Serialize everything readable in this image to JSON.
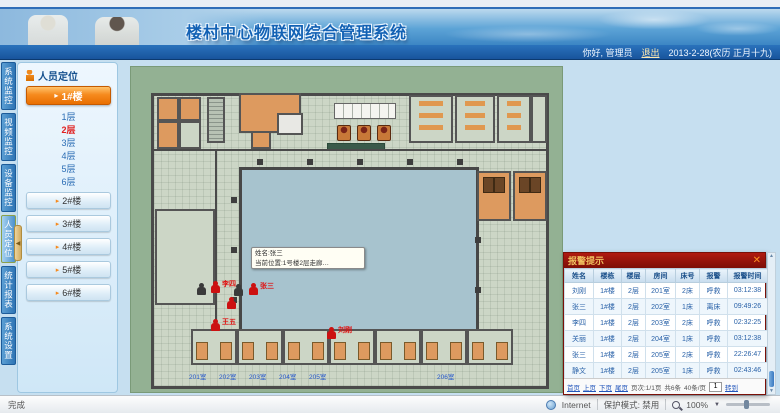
{
  "header": {
    "title": "楼村中心物联网综合管理系统",
    "greeting": "你好, 管理员",
    "logout": "退出",
    "date": "2013-2-28(农历 正月十九)"
  },
  "nav": {
    "tabs": [
      {
        "label": "系统监控",
        "active": false
      },
      {
        "label": "视频监控",
        "active": false
      },
      {
        "label": "设备监控",
        "active": false
      },
      {
        "label": "人员定位",
        "active": true
      },
      {
        "label": "统计报表",
        "active": false
      },
      {
        "label": "系统设置",
        "active": false
      }
    ]
  },
  "sidebar": {
    "panel_title": "人员定位",
    "active_building": "1#楼",
    "floors": [
      {
        "label": "1层",
        "active": false
      },
      {
        "label": "2层",
        "active": true
      },
      {
        "label": "3层",
        "active": false
      },
      {
        "label": "4层",
        "active": false
      },
      {
        "label": "5层",
        "active": false
      },
      {
        "label": "6层",
        "active": false
      }
    ],
    "buildings": [
      "2#楼",
      "3#楼",
      "4#楼",
      "5#楼",
      "6#楼"
    ]
  },
  "floorplan": {
    "tooltip": {
      "line1": "姓名:张三",
      "line2": "当前位置:1号楼2层走廊…"
    },
    "persons": [
      {
        "x": 80,
        "y": 214,
        "label": "李四"
      },
      {
        "x": 118,
        "y": 216,
        "label": "张三"
      },
      {
        "x": 96,
        "y": 230,
        "label": ""
      },
      {
        "x": 80,
        "y": 252,
        "label": "王五"
      },
      {
        "x": 196,
        "y": 260,
        "label": "刘刚"
      }
    ],
    "dark_markers": [
      {
        "x": 66,
        "y": 216
      },
      {
        "x": 103,
        "y": 217
      }
    ],
    "room_labels": [
      {
        "x": 58,
        "label": "201室"
      },
      {
        "x": 88,
        "label": "202室"
      },
      {
        "x": 118,
        "label": "203室"
      },
      {
        "x": 148,
        "label": "204室"
      },
      {
        "x": 178,
        "label": "205室"
      },
      {
        "x": 306,
        "label": "206室"
      }
    ]
  },
  "alarm_panel": {
    "title": "报警提示",
    "columns": [
      "姓名",
      "楼栋",
      "楼层",
      "房间",
      "床号",
      "报警",
      "报警时间"
    ],
    "rows": [
      [
        "刘刚",
        "1#楼",
        "2层",
        "201室",
        "2床",
        "呼救",
        "03:12:38"
      ],
      [
        "张三",
        "1#楼",
        "2层",
        "202室",
        "1床",
        "离床",
        "09:49:26"
      ],
      [
        "李四",
        "1#楼",
        "2层",
        "203室",
        "2床",
        "呼救",
        "02:32:25"
      ],
      [
        "关丽",
        "1#楼",
        "2层",
        "204室",
        "1床",
        "呼救",
        "03:12:38"
      ],
      [
        "张三",
        "1#楼",
        "2层",
        "205室",
        "2床",
        "呼救",
        "22:26:47"
      ],
      [
        "静文",
        "1#楼",
        "2层",
        "205室",
        "1床",
        "呼救",
        "02:43:46"
      ]
    ],
    "pager": {
      "first": "首页",
      "prev": "上页",
      "next": "下页",
      "last": "尾页",
      "info": "页次:1/1页",
      "total": "共6条",
      "per_page": "40条/页",
      "goto_value": "1",
      "goto_label": "转到"
    }
  },
  "statusbar": {
    "left": "完成",
    "zone": "Internet",
    "protected_mode": "保护模式: 禁用",
    "zoom": "100%"
  },
  "icons": {
    "arrow_right": "▸",
    "collapse": "◀",
    "close": "✕",
    "caret_down": "▼",
    "scroll_up": "▲",
    "scroll_down": "▼"
  }
}
